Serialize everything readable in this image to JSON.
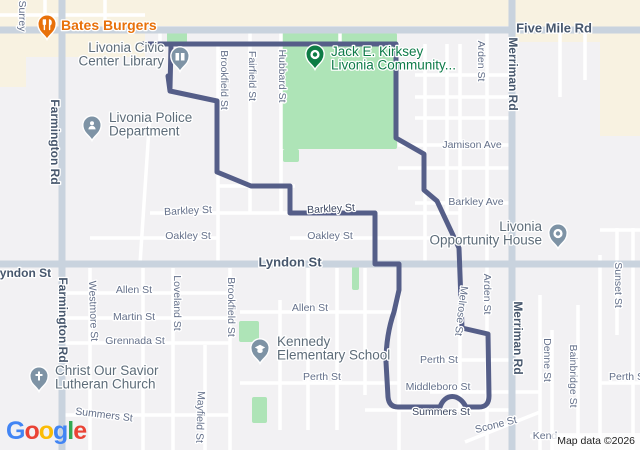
{
  "attribution": "Map data ©2026",
  "google_logo": {
    "letters": [
      {
        "ch": "G",
        "color": "#4285F4"
      },
      {
        "ch": "o",
        "color": "#EA4335"
      },
      {
        "ch": "o",
        "color": "#FBBC05"
      },
      {
        "ch": "g",
        "color": "#4285F4"
      },
      {
        "ch": "l",
        "color": "#34A853"
      },
      {
        "ch": "e",
        "color": "#EA4335"
      }
    ]
  },
  "map": {
    "colors": {
      "land": "#f2f1f3",
      "commercial": "#f8f2e1",
      "park": "#aee4b7",
      "road_minor": "#ffffff",
      "road_major": "#c9d3de",
      "route": "#555e88",
      "poi_gray": "#5d6c79",
      "poi_green": "#0e7b49",
      "poi_orange": "#e8710a",
      "pin_gray": "#7e93a5",
      "pin_green": "#0d7c45",
      "pin_orange": "#e8710a"
    },
    "commercial_areas": [
      {
        "x": 0,
        "y": 0,
        "w": 640,
        "h": 26
      },
      {
        "x": 0,
        "y": 26,
        "w": 145,
        "h": 31
      },
      {
        "x": 0,
        "y": 57,
        "w": 26,
        "h": 30
      },
      {
        "x": 600,
        "y": 26,
        "w": 40,
        "h": 110
      },
      {
        "x": 515,
        "y": 26,
        "w": 85,
        "h": 16
      }
    ],
    "parks": [
      {
        "x": 281,
        "y": 33,
        "w": 116,
        "h": 116
      },
      {
        "x": 283,
        "y": 149,
        "w": 16,
        "h": 13
      },
      {
        "x": 167,
        "y": 32,
        "w": 20,
        "h": 11
      },
      {
        "x": 239,
        "y": 321,
        "w": 20,
        "h": 21
      },
      {
        "x": 252,
        "y": 397,
        "w": 15,
        "h": 26
      },
      {
        "x": 352,
        "y": 266,
        "w": 7,
        "h": 24
      }
    ],
    "roads": {
      "major": [
        [
          0,
          30,
          640,
          30
        ],
        [
          62,
          0,
          62,
          450
        ],
        [
          512,
          0,
          512,
          450
        ],
        [
          0,
          264,
          640,
          264
        ]
      ],
      "minor_v": [
        [
          45,
          0,
          30
        ],
        [
          105,
          0,
          30
        ],
        [
          160,
          30,
          44
        ],
        [
          340,
          30,
          44
        ],
        [
          218,
          44,
          264
        ],
        [
          250,
          30,
          213
        ],
        [
          281,
          30,
          213
        ],
        [
          425,
          44,
          264
        ],
        [
          447,
          44,
          213
        ],
        [
          460,
          44,
          410
        ],
        [
          487,
          30,
          450
        ],
        [
          560,
          30,
          97
        ],
        [
          585,
          30,
          80
        ],
        [
          617,
          228,
          335
        ],
        [
          633,
          228,
          450
        ],
        [
          600,
          255,
          450
        ],
        [
          90,
          268,
          450
        ],
        [
          143,
          268,
          450
        ],
        [
          173,
          268,
          450
        ],
        [
          205,
          345,
          450
        ],
        [
          230,
          268,
          450
        ],
        [
          280,
          300,
          430
        ],
        [
          308,
          268,
          430
        ],
        [
          337,
          268,
          430
        ],
        [
          365,
          268,
          395
        ],
        [
          399,
          264,
          450
        ],
        [
          540,
          295,
          450
        ],
        [
          552,
          330,
          450
        ],
        [
          578,
          305,
          450
        ]
      ],
      "minor_h": [
        [
          15,
          0,
          145
        ],
        [
          44,
          140,
          400
        ],
        [
          75,
          415,
          512
        ],
        [
          97,
          415,
          512
        ],
        [
          118,
          415,
          512
        ],
        [
          145,
          398,
          512
        ],
        [
          168,
          398,
          512
        ],
        [
          203,
          415,
          512
        ],
        [
          186,
          217,
          295
        ],
        [
          213,
          150,
          460
        ],
        [
          238,
          90,
          218
        ],
        [
          238,
          290,
          460
        ],
        [
          293,
          62,
          230
        ],
        [
          318,
          62,
          230
        ],
        [
          343,
          62,
          230
        ],
        [
          415,
          62,
          230
        ],
        [
          312,
          240,
          399
        ],
        [
          383,
          240,
          399
        ],
        [
          360,
          430,
          512
        ],
        [
          392,
          430,
          540
        ],
        [
          410,
          365,
          512
        ],
        [
          383,
          600,
          640
        ],
        [
          230,
          600,
          640
        ],
        [
          436,
          530,
          590
        ]
      ],
      "diagonals": [
        [
          540,
          412,
          465,
          442
        ],
        [
          150,
          113,
          140,
          264
        ]
      ]
    },
    "route": {
      "width": 5,
      "paths": [
        "M143,44 L396,44 L396,138 L424,154 L424,190 L437,201 L459,248 L462,328 L488,334 L489,396 Q489,407 479,407 L466,407 C459,393 445,393 440,407 L398,407 Q389,407 388,397 L386,362 Q386,335 394,312 L399,290 L399,264 L375,264 L375,213 L290,213 L290,186 L251,186 L217,172 L217,101 L170,91 L168,76",
        "M171,45 L170,88"
      ]
    },
    "street_labels": [
      {
        "t": "Surrey",
        "x": 22,
        "y": 16,
        "r": 90,
        "type": "street"
      },
      {
        "t": "Five Mile Rd",
        "x": 554,
        "y": 28,
        "r": 0,
        "s": 13,
        "type": "arterial"
      },
      {
        "t": "Farmington Rd",
        "x": 55,
        "y": 142,
        "r": 90,
        "s": 12,
        "type": "arterial"
      },
      {
        "t": "Farmington Rd",
        "x": 63,
        "y": 320,
        "r": 90,
        "s": 12,
        "type": "arterial"
      },
      {
        "t": "Merriman Rd",
        "x": 513,
        "y": 74,
        "r": 90,
        "s": 12,
        "type": "arterial"
      },
      {
        "t": "Merriman Rd",
        "x": 518,
        "y": 338,
        "r": 90,
        "s": 12,
        "type": "arterial"
      },
      {
        "t": "Arden St",
        "x": 481,
        "y": 61,
        "r": 90,
        "type": "street"
      },
      {
        "t": "Brookfield St",
        "x": 224,
        "y": 80,
        "r": 90,
        "type": "street"
      },
      {
        "t": "Fairfield St",
        "x": 252,
        "y": 76,
        "r": 90,
        "type": "street"
      },
      {
        "t": "Hubbard St",
        "x": 282,
        "y": 76,
        "r": 90,
        "type": "street"
      },
      {
        "t": "Jamison Ave",
        "x": 472,
        "y": 145,
        "r": 0,
        "type": "street"
      },
      {
        "t": "Barkley Ave",
        "x": 476,
        "y": 202,
        "r": 0,
        "type": "street"
      },
      {
        "t": "Barkley St",
        "x": 188,
        "y": 211,
        "r": -3,
        "type": "street"
      },
      {
        "t": "Barkley St",
        "x": 331,
        "y": 209,
        "r": -3,
        "type": "dark"
      },
      {
        "t": "Oakley St",
        "x": 188,
        "y": 236,
        "r": 0,
        "type": "street"
      },
      {
        "t": "Oakley St",
        "x": 330,
        "y": 236,
        "r": 0,
        "type": "street"
      },
      {
        "t": "Lyndon St",
        "x": 290,
        "y": 262,
        "r": 0,
        "s": 13,
        "type": "arterial"
      },
      {
        "t": "Lyndon St",
        "x": 22,
        "y": 273,
        "r": 0,
        "s": 12,
        "type": "arterial"
      },
      {
        "t": "Allen St",
        "x": 134,
        "y": 290,
        "r": 0,
        "type": "street"
      },
      {
        "t": "Martin St",
        "x": 134,
        "y": 317,
        "r": 0,
        "type": "street"
      },
      {
        "t": "Grennada St",
        "x": 135,
        "y": 341,
        "r": 0,
        "type": "street"
      },
      {
        "t": "Westmore St",
        "x": 93,
        "y": 311,
        "r": 88,
        "type": "street"
      },
      {
        "t": "Loveland St",
        "x": 177,
        "y": 303,
        "r": 90,
        "type": "street"
      },
      {
        "t": "Brookfield St",
        "x": 231,
        "y": 307,
        "r": 90,
        "type": "street"
      },
      {
        "t": "Allen St",
        "x": 310,
        "y": 308,
        "r": 0,
        "type": "street"
      },
      {
        "t": "Perth St",
        "x": 322,
        "y": 377,
        "r": 0,
        "type": "street"
      },
      {
        "t": "Perth St",
        "x": 439,
        "y": 360,
        "r": 0,
        "type": "street"
      },
      {
        "t": "Middleboro St",
        "x": 438,
        "y": 387,
        "r": 0,
        "type": "street"
      },
      {
        "t": "Summers St",
        "x": 441,
        "y": 412,
        "r": 0,
        "type": "dark"
      },
      {
        "t": "Melrose St",
        "x": 461,
        "y": 311,
        "r": 97,
        "type": "street"
      },
      {
        "t": "Arden St",
        "x": 487,
        "y": 294,
        "r": 90,
        "type": "street"
      },
      {
        "t": "Denne St",
        "x": 547,
        "y": 360,
        "r": 90,
        "type": "street"
      },
      {
        "t": "Bainbridge St",
        "x": 573,
        "y": 376,
        "r": 90,
        "type": "street"
      },
      {
        "t": "Sunset St",
        "x": 618,
        "y": 285,
        "r": 90,
        "type": "street"
      },
      {
        "t": "Perth St",
        "x": 628,
        "y": 377,
        "r": 0,
        "type": "street"
      },
      {
        "t": "Scone St",
        "x": 496,
        "y": 425,
        "r": -14,
        "type": "street"
      },
      {
        "t": "Kend",
        "x": 545,
        "y": 436,
        "r": 0,
        "type": "street"
      },
      {
        "t": "Summers St",
        "x": 104,
        "y": 415,
        "r": 7,
        "type": "street"
      },
      {
        "t": "Mayfield St",
        "x": 200,
        "y": 417,
        "r": 92,
        "type": "street"
      }
    ],
    "pois": [
      {
        "name": "bates-burgers",
        "icon": "restaurant-icon",
        "px": 47,
        "py": 25,
        "pin": "pin_orange",
        "lines": [
          "Bates Burgers"
        ],
        "lx": 61,
        "ly": 30,
        "lh": 14,
        "anchor": "start",
        "color": "poi_orange",
        "size": 14,
        "bold": true
      },
      {
        "name": "livonia-civic-center-library",
        "icon": "library-icon",
        "px": 180,
        "py": 57,
        "pin": "pin_gray",
        "lines": [
          "Livonia Civic",
          "Center Library"
        ],
        "lx": 164,
        "ly": 52,
        "lh": 13.5,
        "anchor": "end",
        "color": "poi_gray",
        "size": 13.5,
        "bold": false
      },
      {
        "name": "jack-e-kirksey-livonia-community",
        "icon": "place-dot-icon",
        "px": 315,
        "py": 55,
        "pin": "pin_green",
        "lines": [
          "Jack E. Kirksey",
          "Livonia Community..."
        ],
        "lx": 331,
        "ly": 56,
        "lh": 13.5,
        "anchor": "start",
        "color": "poi_green",
        "size": 13.5,
        "bold": false
      },
      {
        "name": "livonia-police-department",
        "icon": "police-icon",
        "px": 92,
        "py": 126,
        "pin": "pin_gray",
        "lines": [
          "Livonia Police",
          "Department"
        ],
        "lx": 109,
        "ly": 122,
        "lh": 13.5,
        "anchor": "start",
        "color": "poi_gray",
        "size": 13.5,
        "bold": false
      },
      {
        "name": "livonia-opportunity-house",
        "icon": "place-dot-icon",
        "px": 558,
        "py": 234,
        "pin": "pin_gray",
        "lines": [
          "Livonia",
          "Opportunity House"
        ],
        "lx": 542,
        "ly": 231,
        "lh": 13.5,
        "anchor": "end",
        "color": "poi_gray",
        "size": 13.5,
        "bold": false
      },
      {
        "name": "christ-our-savior-lutheran-church",
        "icon": "church-icon",
        "px": 39,
        "py": 377,
        "pin": "pin_gray",
        "lines": [
          "Christ Our Savior",
          "Lutheran Church"
        ],
        "lx": 55,
        "ly": 375,
        "lh": 13.5,
        "anchor": "start",
        "color": "poi_gray",
        "size": 13.5,
        "bold": false
      },
      {
        "name": "kennedy-elementary-school",
        "icon": "school-icon",
        "px": 260,
        "py": 349,
        "pin": "pin_gray",
        "lines": [
          "Kennedy",
          "Elementary School"
        ],
        "lx": 277,
        "ly": 346,
        "lh": 13.5,
        "anchor": "start",
        "color": "poi_gray",
        "size": 13.5,
        "bold": false
      }
    ]
  }
}
